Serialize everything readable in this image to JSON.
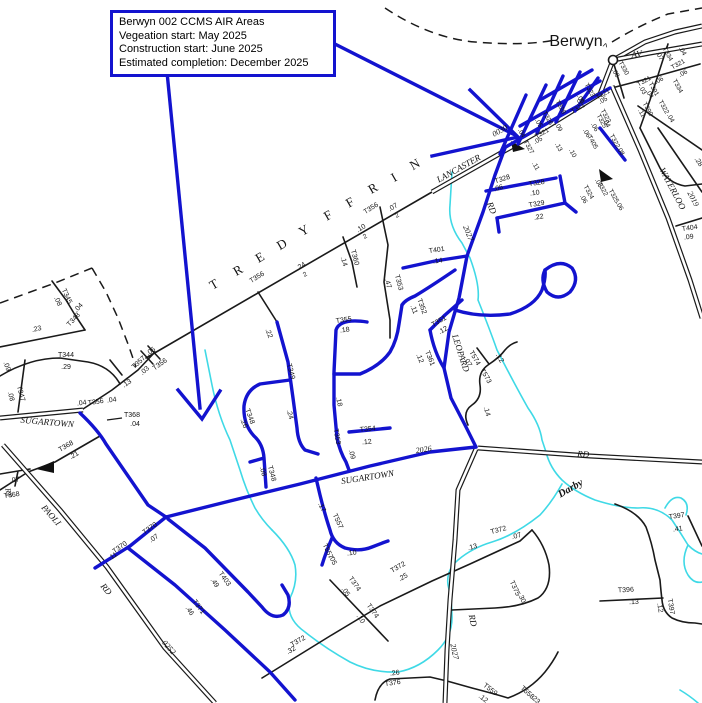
{
  "callout": {
    "line1": "Berwyn 002 CCMS AIR Areas",
    "line2": "Vegeation start: May 2025",
    "line3": "Construction start: June 2025",
    "line4": "Estimated completion: December 2025"
  },
  "town": {
    "name": "Berwyn"
  },
  "colors": {
    "highlight_blue": "#1313cf",
    "road_black": "#1a1a1a",
    "creek_cyan": "#3fd9e6",
    "background": "#ffffff"
  },
  "map": {
    "township_letters": [
      "T",
      "R",
      "E",
      "D",
      "Y",
      "F",
      "F",
      "R",
      "I",
      "N"
    ],
    "labels": [
      {
        "t": "LANCASTER",
        "x": 460,
        "y": 171,
        "r": -29,
        "s": 9,
        "f": "serif",
        "i": 1
      },
      {
        "t": "0030",
        "x": 501,
        "y": 133,
        "r": -29,
        "s": 8,
        "f": "serif",
        "i": 1
      },
      {
        "t": "AV",
        "x": 637,
        "y": 57,
        "r": -8,
        "s": 9,
        "f": "serif",
        "i": 1
      },
      {
        "t": "WATERLOO",
        "x": 670,
        "y": 190,
        "r": 62,
        "s": 9,
        "f": "serif",
        "i": 1
      },
      {
        "t": "2019",
        "x": 691,
        "y": 200,
        "r": 62,
        "s": 8,
        "f": "serif",
        "i": 1
      },
      {
        "t": "SUGARTOWN",
        "x": 47,
        "y": 425,
        "r": 5,
        "s": 9,
        "f": "serif",
        "i": 1
      },
      {
        "t": "SUGARTOWN",
        "x": 368,
        "y": 480,
        "r": -9,
        "s": 9,
        "f": "serif",
        "i": 1
      },
      {
        "t": "2026",
        "x": 424,
        "y": 452,
        "r": -9,
        "s": 8,
        "f": "serif",
        "i": 1
      },
      {
        "t": "RD",
        "x": 583,
        "y": 457,
        "r": 4,
        "s": 9,
        "f": "serif",
        "i": 1
      },
      {
        "t": "RD",
        "x": 470,
        "y": 621,
        "r": 78,
        "s": 9,
        "f": "serif",
        "i": 1
      },
      {
        "t": "2027",
        "x": 452,
        "y": 652,
        "r": 78,
        "s": 8,
        "f": "serif",
        "i": 1
      },
      {
        "t": "2027",
        "x": 466,
        "y": 234,
        "r": 68,
        "s": 8,
        "f": "serif",
        "i": 1
      },
      {
        "t": "RD",
        "x": 489,
        "y": 209,
        "r": 68,
        "s": 9,
        "f": "serif",
        "i": 1
      },
      {
        "t": "LEOPARD",
        "x": 458,
        "y": 354,
        "r": 72,
        "s": 9,
        "f": "serif",
        "i": 1
      },
      {
        "t": "PAOLI",
        "x": 49,
        "y": 517,
        "r": 49,
        "s": 9,
        "f": "serif",
        "i": 1
      },
      {
        "t": "RD",
        "x": 104,
        "y": 591,
        "r": 49,
        "s": 9,
        "f": "serif",
        "i": 1
      },
      {
        "t": "0252",
        "x": 167,
        "y": 649,
        "r": 49,
        "s": 8,
        "f": "serif",
        "i": 1
      },
      {
        "t": "RY",
        "x": 6,
        "y": 493,
        "r": 80,
        "s": 8,
        "f": "serif",
        "i": 1
      },
      {
        "t": "Darby",
        "x": 572,
        "y": 491,
        "r": -30,
        "s": 10.5,
        "f": "serif",
        "i": 1,
        "b": 1,
        "c": "#2ecfdd"
      },
      {
        "t": "Berwyn",
        "x": 576,
        "y": 46,
        "s": 16
      },
      {
        "t": "^",
        "x": 604,
        "y": 50,
        "r": 15,
        "s": 10
      },
      {
        "t": "T",
        "x": 216,
        "y": 288,
        "r": -30,
        "s": 13,
        "f": "serif"
      },
      {
        "t": "R",
        "x": 240,
        "y": 274,
        "r": -30,
        "s": 13,
        "f": "serif"
      },
      {
        "t": "E",
        "x": 262,
        "y": 261,
        "r": -30,
        "s": 13,
        "f": "serif"
      },
      {
        "t": "D",
        "x": 284,
        "y": 248,
        "r": -30,
        "s": 13,
        "f": "serif"
      },
      {
        "t": "Y",
        "x": 306,
        "y": 234,
        "r": -30,
        "s": 13,
        "f": "serif"
      },
      {
        "t": "F",
        "x": 330,
        "y": 219,
        "r": -30,
        "s": 13,
        "f": "serif"
      },
      {
        "t": "F",
        "x": 352,
        "y": 206,
        "r": -30,
        "s": 13,
        "f": "serif"
      },
      {
        "t": "R",
        "x": 375,
        "y": 192,
        "r": -30,
        "s": 13,
        "f": "serif"
      },
      {
        "t": "I",
        "x": 396,
        "y": 181,
        "r": -30,
        "s": 13,
        "f": "serif"
      },
      {
        "t": "N",
        "x": 417,
        "y": 168,
        "r": -30,
        "s": 13,
        "f": "serif"
      },
      {
        "t": ".23",
        "x": 37,
        "y": 331,
        "r": -12
      },
      {
        "t": "T345",
        "x": 65,
        "y": 297,
        "r": 65
      },
      {
        "t": ".08",
        "x": 56,
        "y": 302,
        "r": 65
      },
      {
        "t": "T348",
        "x": 75,
        "y": 321,
        "r": -47
      },
      {
        "t": ".04",
        "x": 80,
        "y": 309,
        "r": -47
      },
      {
        "t": "T344",
        "x": 66,
        "y": 357
      },
      {
        "t": ".29",
        "x": 66,
        "y": 369
      },
      {
        "t": ".09",
        "x": 5,
        "y": 367,
        "r": 70
      },
      {
        "t": "T347",
        "x": 19,
        "y": 394,
        "r": 75
      },
      {
        "t": ".08",
        "x": 9,
        "y": 397,
        "r": 75
      },
      {
        "t": "T357",
        "x": 140,
        "y": 364,
        "r": -42
      },
      {
        "t": ".03",
        "x": 146,
        "y": 372,
        "r": -42
      },
      {
        "t": ".05",
        "x": 152,
        "y": 353,
        "r": -35
      },
      {
        "t": "T356",
        "x": 161,
        "y": 366,
        "r": -35
      },
      {
        "t": ".13",
        "x": 128,
        "y": 385,
        "r": -35
      },
      {
        "t": ".04",
        "x": 82,
        "y": 405,
        "r": -8
      },
      {
        "t": "T356",
        "x": 96,
        "y": 404,
        "r": -8
      },
      {
        "t": ".04",
        "x": 112,
        "y": 402,
        "r": -8
      },
      {
        "t": "T368",
        "x": 132,
        "y": 417
      },
      {
        "t": ".04",
        "x": 135,
        "y": 426
      },
      {
        "t": "T368",
        "x": 67,
        "y": 448,
        "r": -30
      },
      {
        "t": ".21",
        "x": 75,
        "y": 457,
        "r": -30
      },
      {
        "t": ".07",
        "x": 15,
        "y": 482,
        "r": -8
      },
      {
        "t": "T368",
        "x": 12,
        "y": 497,
        "r": -8
      },
      {
        "t": "T356",
        "x": 258,
        "y": 279,
        "r": -32
      },
      {
        "t": ".24",
        "x": 302,
        "y": 268,
        "r": -32
      },
      {
        "t": "2",
        "x": 306,
        "y": 276,
        "r": -32,
        "s": 6.5
      },
      {
        "t": ".10",
        "x": 362,
        "y": 230,
        "r": -32
      },
      {
        "t": "2",
        "x": 366,
        "y": 238,
        "r": -32,
        "s": 6.5
      },
      {
        "t": "T356",
        "x": 372,
        "y": 210,
        "r": -32
      },
      {
        "t": ".07",
        "x": 394,
        "y": 209,
        "r": -32
      },
      {
        "t": "2",
        "x": 398,
        "y": 217,
        "r": -32,
        "s": 6.5
      },
      {
        "t": "T360",
        "x": 353,
        "y": 258,
        "r": 75
      },
      {
        "t": ".14",
        "x": 342,
        "y": 262,
        "r": 75
      },
      {
        "t": "T353",
        "x": 397,
        "y": 283,
        "r": 75
      },
      {
        "t": ".47",
        "x": 386,
        "y": 284,
        "r": 75
      },
      {
        "t": ".22",
        "x": 267,
        "y": 334,
        "r": 70
      },
      {
        "t": "T349",
        "x": 289,
        "y": 372,
        "r": 75
      },
      {
        "t": ".24",
        "x": 288,
        "y": 415,
        "r": 75
      },
      {
        "t": "T348",
        "x": 248,
        "y": 417,
        "r": 70
      },
      {
        "t": ".26",
        "x": 242,
        "y": 424,
        "r": 70
      },
      {
        "t": "T348",
        "x": 270,
        "y": 474,
        "r": 75
      },
      {
        "t": ".08",
        "x": 261,
        "y": 472,
        "r": 75
      },
      {
        "t": "T355",
        "x": 344,
        "y": 322,
        "r": -8
      },
      {
        "t": ".18",
        "x": 345,
        "y": 332,
        "r": -8
      },
      {
        "t": ".18",
        "x": 337,
        "y": 402,
        "r": 78
      },
      {
        "t": "T353",
        "x": 335,
        "y": 437,
        "r": 80
      },
      {
        "t": ".09",
        "x": 350,
        "y": 455,
        "r": 75
      },
      {
        "t": "T354",
        "x": 368,
        "y": 431,
        "r": -5
      },
      {
        "t": ".12",
        "x": 367,
        "y": 444,
        "r": -5
      },
      {
        "t": "T352",
        "x": 420,
        "y": 307,
        "r": 70
      },
      {
        "t": ".11",
        "x": 412,
        "y": 310,
        "r": 70
      },
      {
        "t": "T351",
        "x": 440,
        "y": 323,
        "r": -30
      },
      {
        "t": ".12",
        "x": 444,
        "y": 332,
        "r": -30
      },
      {
        "t": "T361",
        "x": 428,
        "y": 359,
        "r": 68
      },
      {
        "t": ".12",
        "x": 418,
        "y": 359,
        "r": 68
      },
      {
        "t": "T401",
        "x": 437,
        "y": 252,
        "r": -8
      },
      {
        "t": ".14",
        "x": 438,
        "y": 263,
        "r": -8
      },
      {
        "t": "T574",
        "x": 473,
        "y": 359,
        "r": 60
      },
      {
        "t": ".07",
        "x": 466,
        "y": 363,
        "r": 60
      },
      {
        "t": "T573",
        "x": 484,
        "y": 377,
        "r": 60
      },
      {
        "t": ".12",
        "x": 498,
        "y": 359,
        "r": 60
      },
      {
        "t": ".14",
        "x": 485,
        "y": 412,
        "r": 75
      },
      {
        "t": "T323",
        "x": 588,
        "y": 91,
        "r": 61,
        "s": 6.5
      },
      {
        "t": ".09",
        "x": 579,
        "y": 100,
        "r": 61,
        "s": 6.5
      },
      {
        "t": "T326",
        "x": 546,
        "y": 119,
        "r": 61,
        "s": 6.5
      },
      {
        "t": ".05",
        "x": 537,
        "y": 124,
        "r": 61,
        "s": 6.5
      },
      {
        "t": ".09",
        "x": 557,
        "y": 128,
        "r": 61,
        "s": 6.5
      },
      {
        "t": "T321",
        "x": 543,
        "y": 135,
        "r": -29,
        "s": 6.5
      },
      {
        "t": ".05",
        "x": 539,
        "y": 142,
        "r": -29,
        "s": 6.5
      },
      {
        "t": "T327",
        "x": 527,
        "y": 148,
        "r": 61,
        "s": 6.5
      },
      {
        "t": ".04",
        "x": 520,
        "y": 134,
        "r": 61,
        "s": 6.5
      },
      {
        "t": ".11",
        "x": 534,
        "y": 167,
        "r": 61,
        "s": 6.5
      },
      {
        "t": "T328",
        "x": 559,
        "y": 108,
        "r": 61,
        "s": 6.5
      },
      {
        "t": ".13",
        "x": 557,
        "y": 148,
        "r": 61,
        "s": 6.5
      },
      {
        "t": ".10",
        "x": 571,
        "y": 154,
        "r": 61,
        "s": 6.5
      },
      {
        "t": "T321",
        "x": 579,
        "y": 110,
        "r": -29,
        "s": 6.5
      },
      {
        "t": ".04",
        "x": 581,
        "y": 103,
        "r": -29,
        "s": 6.5
      },
      {
        "t": "T325",
        "x": 600,
        "y": 122,
        "r": 61,
        "s": 6.5
      },
      {
        "t": ".06",
        "x": 593,
        "y": 128,
        "r": 61,
        "s": 6.5
      },
      {
        "t": "T405",
        "x": 591,
        "y": 143,
        "r": 61,
        "s": 6.5
      },
      {
        "t": ".06",
        "x": 585,
        "y": 134,
        "r": 61,
        "s": 6.5
      },
      {
        "t": "T322",
        "x": 613,
        "y": 142,
        "r": 61,
        "s": 6.5
      },
      {
        "t": ".08",
        "x": 619,
        "y": 152,
        "r": 61,
        "s": 6.5
      },
      {
        "t": "T323",
        "x": 604,
        "y": 117,
        "r": 61,
        "s": 6.5
      },
      {
        "t": ".04",
        "x": 605,
        "y": 124,
        "r": 61,
        "s": 6.5
      },
      {
        "t": "T321",
        "x": 604,
        "y": 96,
        "r": -29,
        "s": 6.5
      },
      {
        "t": ".05",
        "x": 604,
        "y": 102,
        "r": -29,
        "s": 6.5
      },
      {
        "t": "T330",
        "x": 622,
        "y": 69,
        "r": 61,
        "s": 6.5
      },
      {
        "t": ".08",
        "x": 614,
        "y": 74,
        "r": 61,
        "s": 6.5
      },
      {
        "t": "T321",
        "x": 645,
        "y": 83,
        "r": -29,
        "s": 6.5
      },
      {
        "t": ".03",
        "x": 641,
        "y": 91,
        "r": 61,
        "s": 6.5
      },
      {
        "t": ".04",
        "x": 648,
        "y": 95,
        "r": 61,
        "s": 6.5
      },
      {
        "t": "T391",
        "x": 652,
        "y": 90,
        "r": 61,
        "s": 6.5
      },
      {
        "t": "T390",
        "x": 646,
        "y": 110,
        "r": 61,
        "s": 6.5
      },
      {
        "t": ".11",
        "x": 640,
        "y": 114,
        "r": 61,
        "s": 6.5
      },
      {
        "t": "T322",
        "x": 662,
        "y": 108,
        "r": 61,
        "s": 6.5
      },
      {
        "t": ".04",
        "x": 669,
        "y": 119,
        "r": 61,
        "s": 6.5
      },
      {
        "t": "T334",
        "x": 676,
        "y": 87,
        "r": 61,
        "s": 6.5
      },
      {
        "t": ".06",
        "x": 660,
        "y": 82,
        "r": -29,
        "s": 6.5
      },
      {
        "t": "T321",
        "x": 679,
        "y": 66,
        "r": -29,
        "s": 6.5
      },
      {
        "t": ".06",
        "x": 684,
        "y": 75,
        "r": -29,
        "s": 6.5
      },
      {
        "t": "T334",
        "x": 666,
        "y": 55,
        "r": 61,
        "s": 6.5
      },
      {
        "t": ".07",
        "x": 658,
        "y": 57,
        "r": 61,
        "s": 6.5
      },
      {
        "t": ".04",
        "x": 681,
        "y": 52,
        "r": 61,
        "s": 6.5
      },
      {
        "t": "T322",
        "x": 601,
        "y": 190,
        "r": 61,
        "s": 6.5
      },
      {
        "t": ".03",
        "x": 597,
        "y": 184,
        "r": 61,
        "s": 6.5
      },
      {
        "t": "T324",
        "x": 587,
        "y": 193,
        "r": 61,
        "s": 6.5
      },
      {
        "t": ".06",
        "x": 582,
        "y": 200,
        "r": 61,
        "s": 6.5
      },
      {
        "t": "T325",
        "x": 612,
        "y": 197,
        "r": 61,
        "s": 6.5
      },
      {
        "t": ".06",
        "x": 618,
        "y": 207,
        "r": 61,
        "s": 6.5
      },
      {
        "t": "T328",
        "x": 503,
        "y": 181,
        "r": -18
      },
      {
        "t": ".06",
        "x": 499,
        "y": 190,
        "r": -18
      },
      {
        "t": "T328",
        "x": 537,
        "y": 185,
        "r": -8
      },
      {
        "t": ".10",
        "x": 535,
        "y": 195,
        "r": -8
      },
      {
        "t": "T329",
        "x": 537,
        "y": 206,
        "r": -10
      },
      {
        "t": ".22",
        "x": 539,
        "y": 219,
        "r": -10
      },
      {
        "t": "T404",
        "x": 690,
        "y": 230,
        "r": -8
      },
      {
        "t": ".09",
        "x": 689,
        "y": 239,
        "r": -8
      },
      {
        "t": ".28",
        "x": 697,
        "y": 163,
        "r": 55
      },
      {
        "t": "T370",
        "x": 121,
        "y": 549,
        "r": -35
      },
      {
        "t": ".11",
        "x": 114,
        "y": 558,
        "r": -35
      },
      {
        "t": "T370",
        "x": 151,
        "y": 530,
        "r": -35
      },
      {
        "t": ".07",
        "x": 155,
        "y": 540,
        "r": -35
      },
      {
        "t": "T403",
        "x": 223,
        "y": 580,
        "r": 55
      },
      {
        "t": ".49",
        "x": 213,
        "y": 584,
        "r": 55
      },
      {
        "t": "T371",
        "x": 197,
        "y": 608,
        "r": 55
      },
      {
        "t": ".46",
        "x": 188,
        "y": 612,
        "r": 55
      },
      {
        "t": "T557",
        "x": 336,
        "y": 522,
        "r": 65
      },
      {
        "t": ".17",
        "x": 320,
        "y": 508,
        "r": 65
      },
      {
        "t": "T557",
        "x": 326,
        "y": 552,
        "r": 65
      },
      {
        "t": ".05",
        "x": 331,
        "y": 561,
        "r": 65
      },
      {
        "t": ".10",
        "x": 352,
        "y": 555,
        "r": -8
      },
      {
        "t": "T372",
        "x": 399,
        "y": 569,
        "r": -30
      },
      {
        "t": ".25",
        "x": 404,
        "y": 579,
        "r": -30
      },
      {
        "t": "T374",
        "x": 353,
        "y": 585,
        "r": 55
      },
      {
        "t": ".05",
        "x": 344,
        "y": 593,
        "r": 55
      },
      {
        "t": "T374",
        "x": 371,
        "y": 612,
        "r": 55
      },
      {
        "t": ".10",
        "x": 359,
        "y": 620,
        "r": 55
      },
      {
        "t": "T372",
        "x": 299,
        "y": 643,
        "r": -30
      },
      {
        "t": ".32",
        "x": 292,
        "y": 652,
        "r": -30
      },
      {
        "t": "T372",
        "x": 499,
        "y": 532,
        "r": -15
      },
      {
        "t": ".13",
        "x": 473,
        "y": 549,
        "r": -15
      },
      {
        "t": ".07",
        "x": 517,
        "y": 538,
        "r": -15
      },
      {
        "t": "T375",
        "x": 513,
        "y": 589,
        "r": 65
      },
      {
        "t": ".30",
        "x": 520,
        "y": 599,
        "r": 65
      },
      {
        "t": "T376",
        "x": 393,
        "y": 685,
        "r": -8
      },
      {
        "t": ".26",
        "x": 395,
        "y": 675,
        "r": -8
      },
      {
        "t": "T559",
        "x": 489,
        "y": 691,
        "r": 38
      },
      {
        "t": ".12",
        "x": 482,
        "y": 700,
        "r": 38
      },
      {
        "t": "T558",
        "x": 526,
        "y": 694,
        "r": 42
      },
      {
        "t": ".23",
        "x": 534,
        "y": 701,
        "r": 42
      },
      {
        "t": "T396",
        "x": 626,
        "y": 592,
        "r": -3
      },
      {
        "t": ".13",
        "x": 634,
        "y": 604,
        "r": -3
      },
      {
        "t": "T397",
        "x": 677,
        "y": 518,
        "r": -8
      },
      {
        "t": ".41",
        "x": 678,
        "y": 531,
        "r": -8
      },
      {
        "t": "T397",
        "x": 669,
        "y": 607,
        "r": 80
      },
      {
        "t": ".12",
        "x": 658,
        "y": 608,
        "r": 80
      }
    ]
  }
}
